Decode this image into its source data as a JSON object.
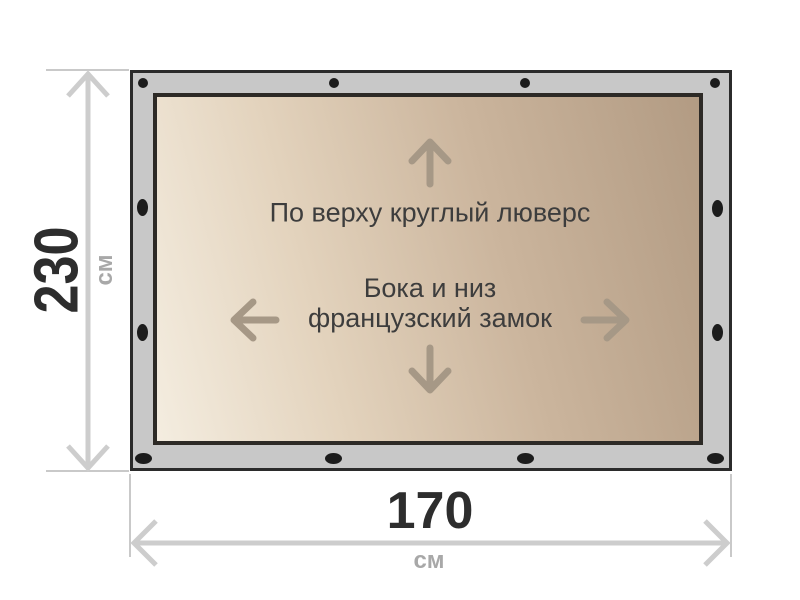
{
  "labels": {
    "top_note": "По верху круглый люверс",
    "center_note_line1": "Бока и низ",
    "center_note_line2": "французский замок"
  },
  "dimensions": {
    "height": {
      "value": "230",
      "unit": "см"
    },
    "width": {
      "value": "170",
      "unit": "см"
    }
  },
  "colors": {
    "tarp_border_band": "#c8c8c8",
    "tarp_outline": "#2b2b2b",
    "fabric_light": "#f4ede0",
    "fabric_dark": "#b29b83",
    "grommet": "#1c1c1c",
    "content_arrow": "#a69886",
    "dimension_line": "#cdcdcd",
    "dimension_value_text": "#2d2d2d",
    "dimension_unit_text": "#a8a8a8",
    "note_text": "#3d3d3d"
  }
}
